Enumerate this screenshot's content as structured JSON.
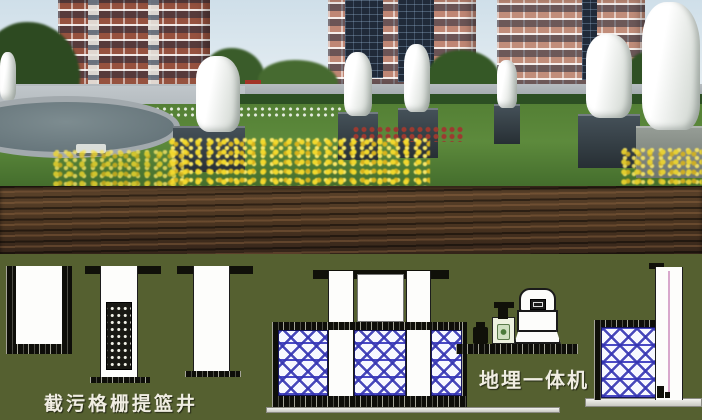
{
  "labels": {
    "intercept_grille_basket_well": "截污格栅提篮井",
    "buried_integrated_unit": "地埋一体机"
  },
  "colors": {
    "underground_background": "#556030",
    "soil_band": "#49331f",
    "lattice_blue": "#3b3bb0",
    "structure_black": "#101009",
    "label_text": "#f0ede2",
    "lawn_green": "#5d8a3c",
    "flower_yellow": "#e2c525",
    "building_brick": "#96523f",
    "building_salmon": "#c18d7a",
    "statue_white": "#f3f5f2"
  },
  "scene": {
    "above_ground": [
      "apartment-buildings",
      "trees",
      "statues",
      "fountain",
      "lawn",
      "flower-beds"
    ],
    "cross_section": [
      "collection-well",
      "grille-basket-well",
      "inspection-well",
      "treatment-tank",
      "equipment-platform",
      "aeration-tank",
      "discharge-shaft"
    ]
  }
}
